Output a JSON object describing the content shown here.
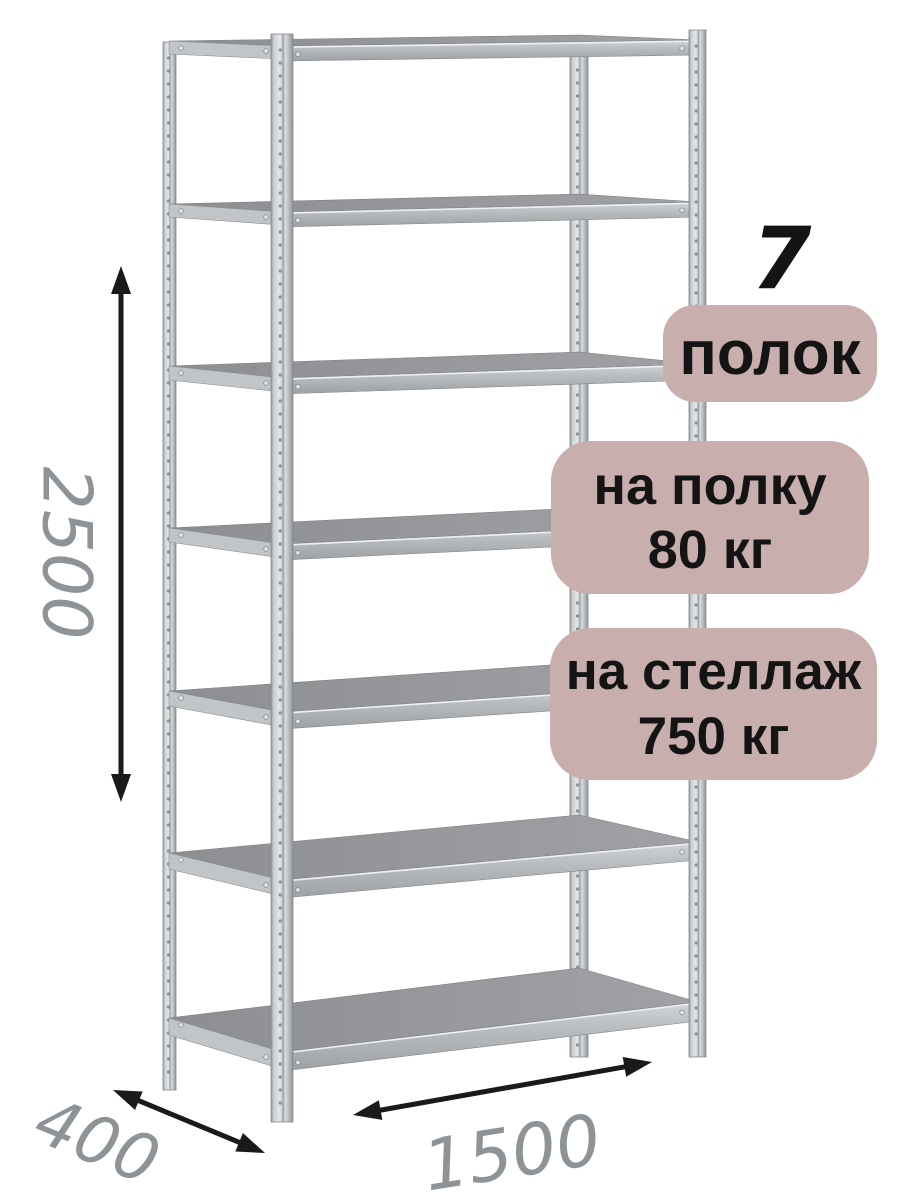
{
  "illustration": {
    "subject": "metal-shelving-rack",
    "shelves_visible": 7,
    "posts_visible": 4
  },
  "dimensions": {
    "height_mm": "2500",
    "depth_mm": "400",
    "width_mm": "1500"
  },
  "callouts": {
    "shelf_count": {
      "number": "7",
      "label": "полок"
    },
    "shelf_load": {
      "line1": "на полку",
      "line2": "80 кг"
    },
    "rack_load": {
      "line1": "на стеллаж",
      "line2": "750 кг"
    }
  },
  "colors": {
    "background": "#ffffff",
    "badge_bg": "#c9aeae",
    "badge_text": "#141414",
    "dimension_text": "#8d9396",
    "arrow": "#1a1a1a",
    "metal_light": "#ced1d4",
    "metal_mid": "#b4b8bb",
    "metal_dark": "#8f9397",
    "shelf_top": "#919396",
    "shelf_band": "#bcbfc2"
  }
}
